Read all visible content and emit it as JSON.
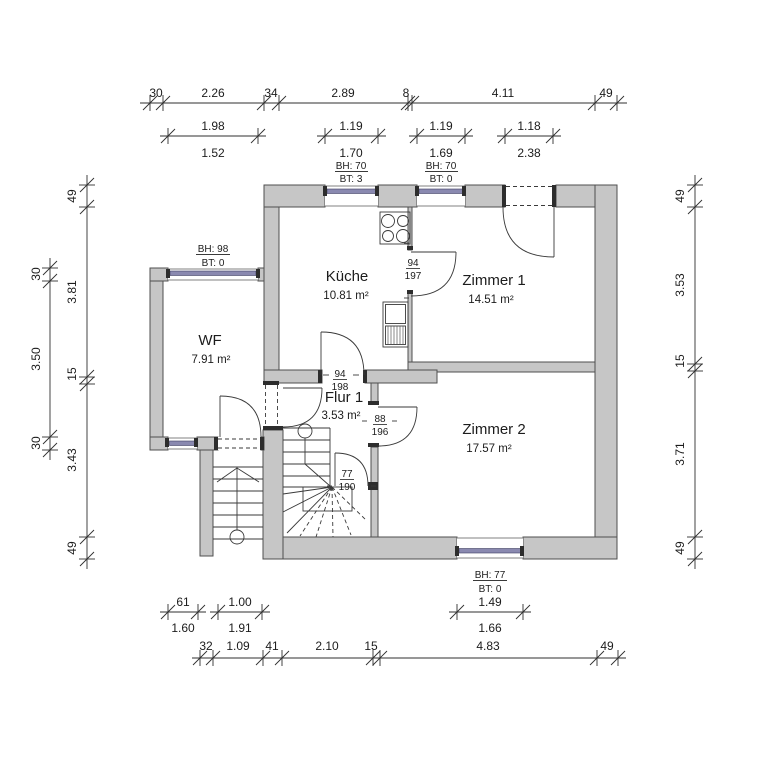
{
  "rooms": [
    {
      "name": "Küche",
      "area": "10.81 m²"
    },
    {
      "name": "Zimmer 1",
      "area": "14.51 m²"
    },
    {
      "name": "WF",
      "area": "7.91 m²"
    },
    {
      "name": "Flur 1",
      "area": "3.53 m²"
    },
    {
      "name": "Zimmer 2",
      "area": "17.57 m²"
    }
  ],
  "dims": {
    "top_chain": [
      "30",
      "2.26",
      "34",
      "2.89",
      "8",
      "4.11",
      "49"
    ],
    "top_openings_upper": [
      "1.98",
      "1.19",
      "1.19",
      "1.18"
    ],
    "top_openings_lower": [
      "1.52",
      "1.70",
      "1.69",
      "2.38"
    ],
    "left_outer": [
      "30",
      "3.50",
      "30"
    ],
    "left_inner": [
      "49",
      "3.81",
      "15",
      "3.43",
      "49"
    ],
    "right_chain": [
      "49",
      "3.53",
      "15",
      "3.71",
      "49"
    ],
    "bottom_chain": [
      "32",
      "1.09",
      "41",
      "2.10",
      "15",
      "4.83",
      "49"
    ],
    "bottom_openings_upper": [
      "61",
      "1.00",
      "1.49"
    ],
    "bottom_openings_lower": [
      "1.60",
      "1.91",
      "1.66"
    ]
  },
  "window_annotations": {
    "kitchen": {
      "bh": "BH: 70",
      "bt": "BT: 3"
    },
    "top2": {
      "bh": "BH: 70",
      "bt": "BT: 0"
    },
    "wf": {
      "bh": "BH: 98",
      "bt": "BT: 0"
    },
    "zimmer2": {
      "bh": "BH: 77",
      "bt": "BT: 0"
    }
  },
  "doors": [
    {
      "w": "94",
      "h": "197"
    },
    {
      "w": "94",
      "h": "198"
    },
    {
      "w": "88",
      "h": "196"
    },
    {
      "w": "77",
      "h": "190"
    }
  ],
  "colors": {
    "wall": "#c6c6c6",
    "wall_outline": "#4f4f4f",
    "glazing": "#8a89b0",
    "line": "#3a3a3a",
    "text": "#1c1c1c"
  }
}
